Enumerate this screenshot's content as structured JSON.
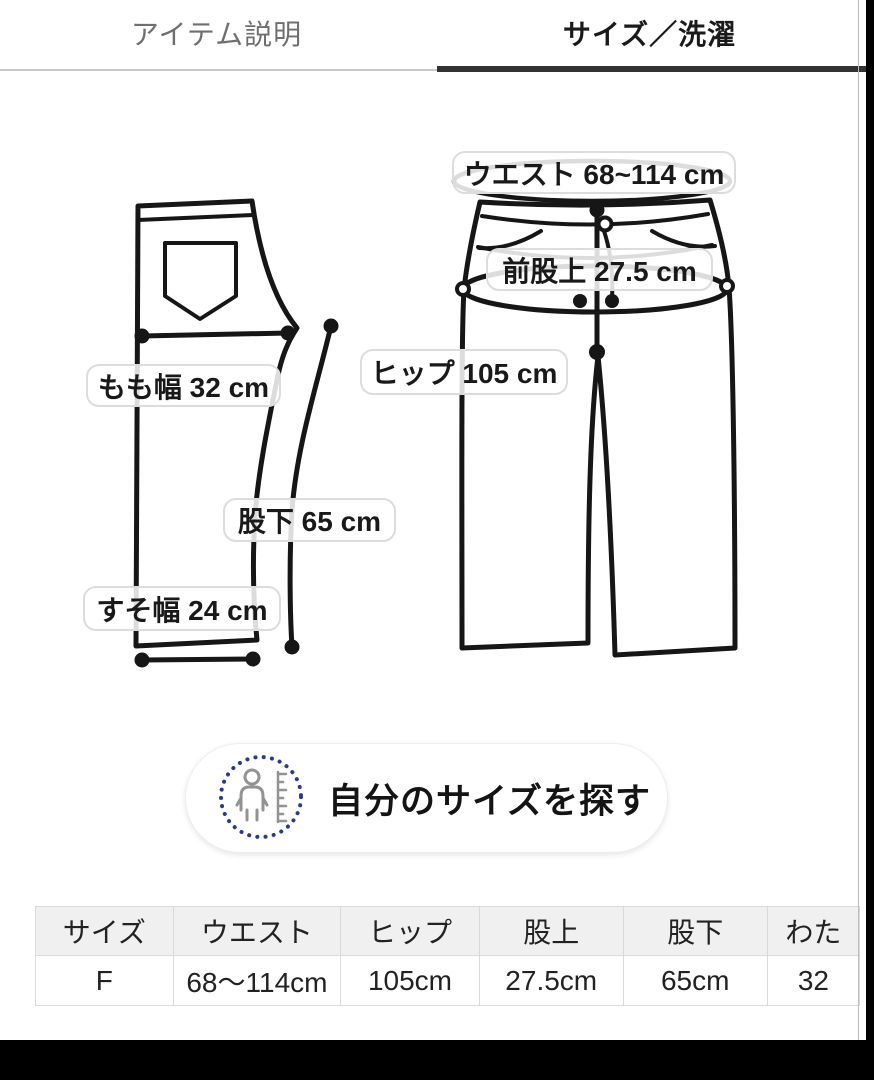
{
  "tabs": [
    {
      "label": "アイテム説明",
      "active": false
    },
    {
      "label": "サイズ／洗濯",
      "active": true
    }
  ],
  "diagram": {
    "labels": {
      "waist": "ウエスト 68~114 cm",
      "front_rise": "前股上 27.5 cm",
      "hip": "ヒップ 105 cm",
      "thigh": "もも幅 32 cm",
      "inseam": "股下 65 cm",
      "hem": "すそ幅 24 cm"
    }
  },
  "find_size_button": {
    "label": "自分のサイズを探す",
    "icon": "body-measure-icon",
    "ring_color": "#2c3a8c"
  },
  "size_table": {
    "headers": [
      "サイズ",
      "ウエスト",
      "ヒップ",
      "股上",
      "股下",
      "わた"
    ],
    "rows": [
      [
        "F",
        "68〜114cm",
        "105cm",
        "27.5cm",
        "65cm",
        "32"
      ]
    ]
  }
}
